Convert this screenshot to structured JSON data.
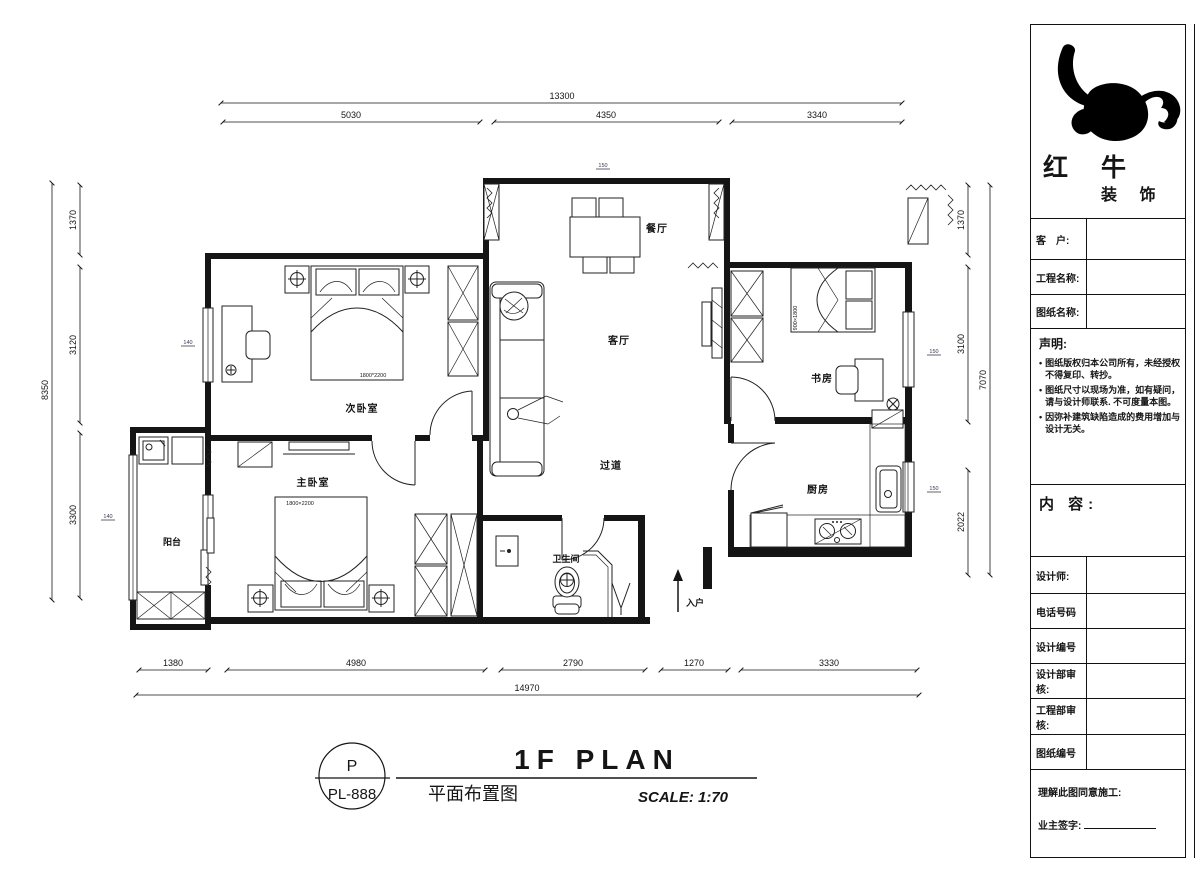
{
  "panel": {
    "brand": {
      "line1": "红 牛",
      "line2": "装 饰"
    },
    "fields": [
      {
        "label": "客　户:"
      },
      {
        "label": "工程名称:"
      },
      {
        "label": "图纸名称:"
      }
    ],
    "statement": {
      "title": "声明:",
      "items": [
        "图纸版权归本公司所有，未经授权不得复印、转抄。",
        "图纸尺寸以现场为准，如有疑问，请与设计师联系. 不可度量本图。",
        "因弥补建筑缺陷造成的费用增加与设计无关。"
      ]
    },
    "content_label": "内 容:",
    "rows": [
      {
        "label": "设计师:"
      },
      {
        "label": "电话号码"
      },
      {
        "label": "设计编号"
      },
      {
        "label": "设计部审核:"
      },
      {
        "label": "工程部审核:"
      },
      {
        "label": "图纸编号"
      }
    ],
    "footer": {
      "line1": "理解此图同意施工:",
      "line2": "业主签字:"
    }
  },
  "titleblock": {
    "code_top": "P",
    "code_bottom": "PL-888",
    "title_en": "1F PLAN",
    "title_cn": "平面布置图",
    "scale": "SCALE: 1:70"
  },
  "plan": {
    "rooms": {
      "dining": "餐厅",
      "living": "客厅",
      "bedroom2": "次卧室",
      "master": "主卧室",
      "study": "书房",
      "kitchen": "厨房",
      "hall": "过道",
      "bath": "卫生间",
      "balcony": "阳台",
      "entry": "入户"
    },
    "furniture_labels": {
      "bed2_size": "1800*2200",
      "master_bed_size": "1800×2200",
      "study_bed_size": "900×1800"
    },
    "dims": {
      "top": {
        "overall": "13300",
        "segments": [
          "5030",
          "4350",
          "3340"
        ]
      },
      "bottom": {
        "overall": "14970",
        "segments": [
          "1380",
          "4980",
          "2790",
          "1270",
          "3330"
        ]
      },
      "left": {
        "overall": "8350",
        "segments": [
          "1370",
          "3120",
          "3300"
        ]
      },
      "right": {
        "overall": "7070",
        "segments": [
          "1370",
          "3100",
          "2022"
        ]
      },
      "ticks": [
        "150",
        "140",
        "140",
        "150",
        "150"
      ]
    }
  }
}
